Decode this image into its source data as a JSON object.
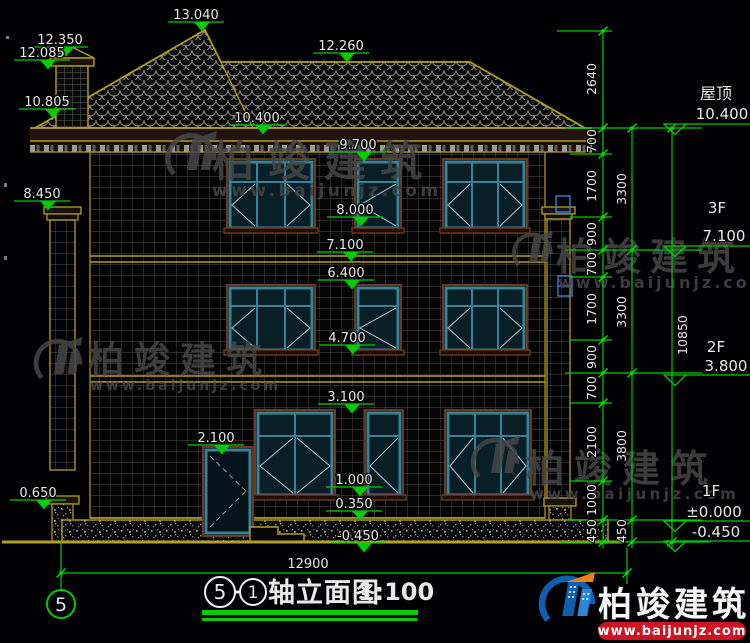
{
  "drawing": {
    "marks": {
      "peak": "13.040",
      "chimney_top": "12.350",
      "chimney_cap": "12.085",
      "eave_left": "10.805",
      "ridge": "12.260",
      "eave": "10.400",
      "win3_top": "9.700",
      "col_cap": "8.450",
      "win3_bot": "8.000",
      "f3_level": "7.100",
      "win2_top": "6.400",
      "win2_bot": "4.700",
      "win1_top": "3.100",
      "door_top": "2.100",
      "win1_bot": "1.000",
      "plinth": "0.350",
      "pedestal": "0.650",
      "ground": "-0.450"
    },
    "axis_bubble": "5",
    "bottom_dim": "12900"
  },
  "right_panel": {
    "roof_label": "屋顶",
    "roof_value": "10.400",
    "f3_label": "3F",
    "f3_value": "7.100",
    "f2_label": "2F",
    "f2_value": "3.800",
    "f1_label": "1F",
    "f1_zero": "±0.000",
    "f1_below": "-0.450",
    "chain_inner": [
      "2640",
      "700",
      "1700",
      "900",
      "700",
      "1700",
      "900",
      "700",
      "2100",
      "1000",
      "450"
    ],
    "chain_mid": [
      "3300",
      "3300",
      "3800",
      "450"
    ],
    "chain_outer": [
      "10850"
    ]
  },
  "title": {
    "axis_from": "5",
    "axis_to": "1",
    "name": "轴立面图",
    "scale": "1:100"
  },
  "watermark": {
    "brand": "柏竣建筑",
    "url": "www.baijunjz.com"
  },
  "logo": {
    "brand": "柏竣建筑",
    "url": "www.baijunjz.com"
  }
}
